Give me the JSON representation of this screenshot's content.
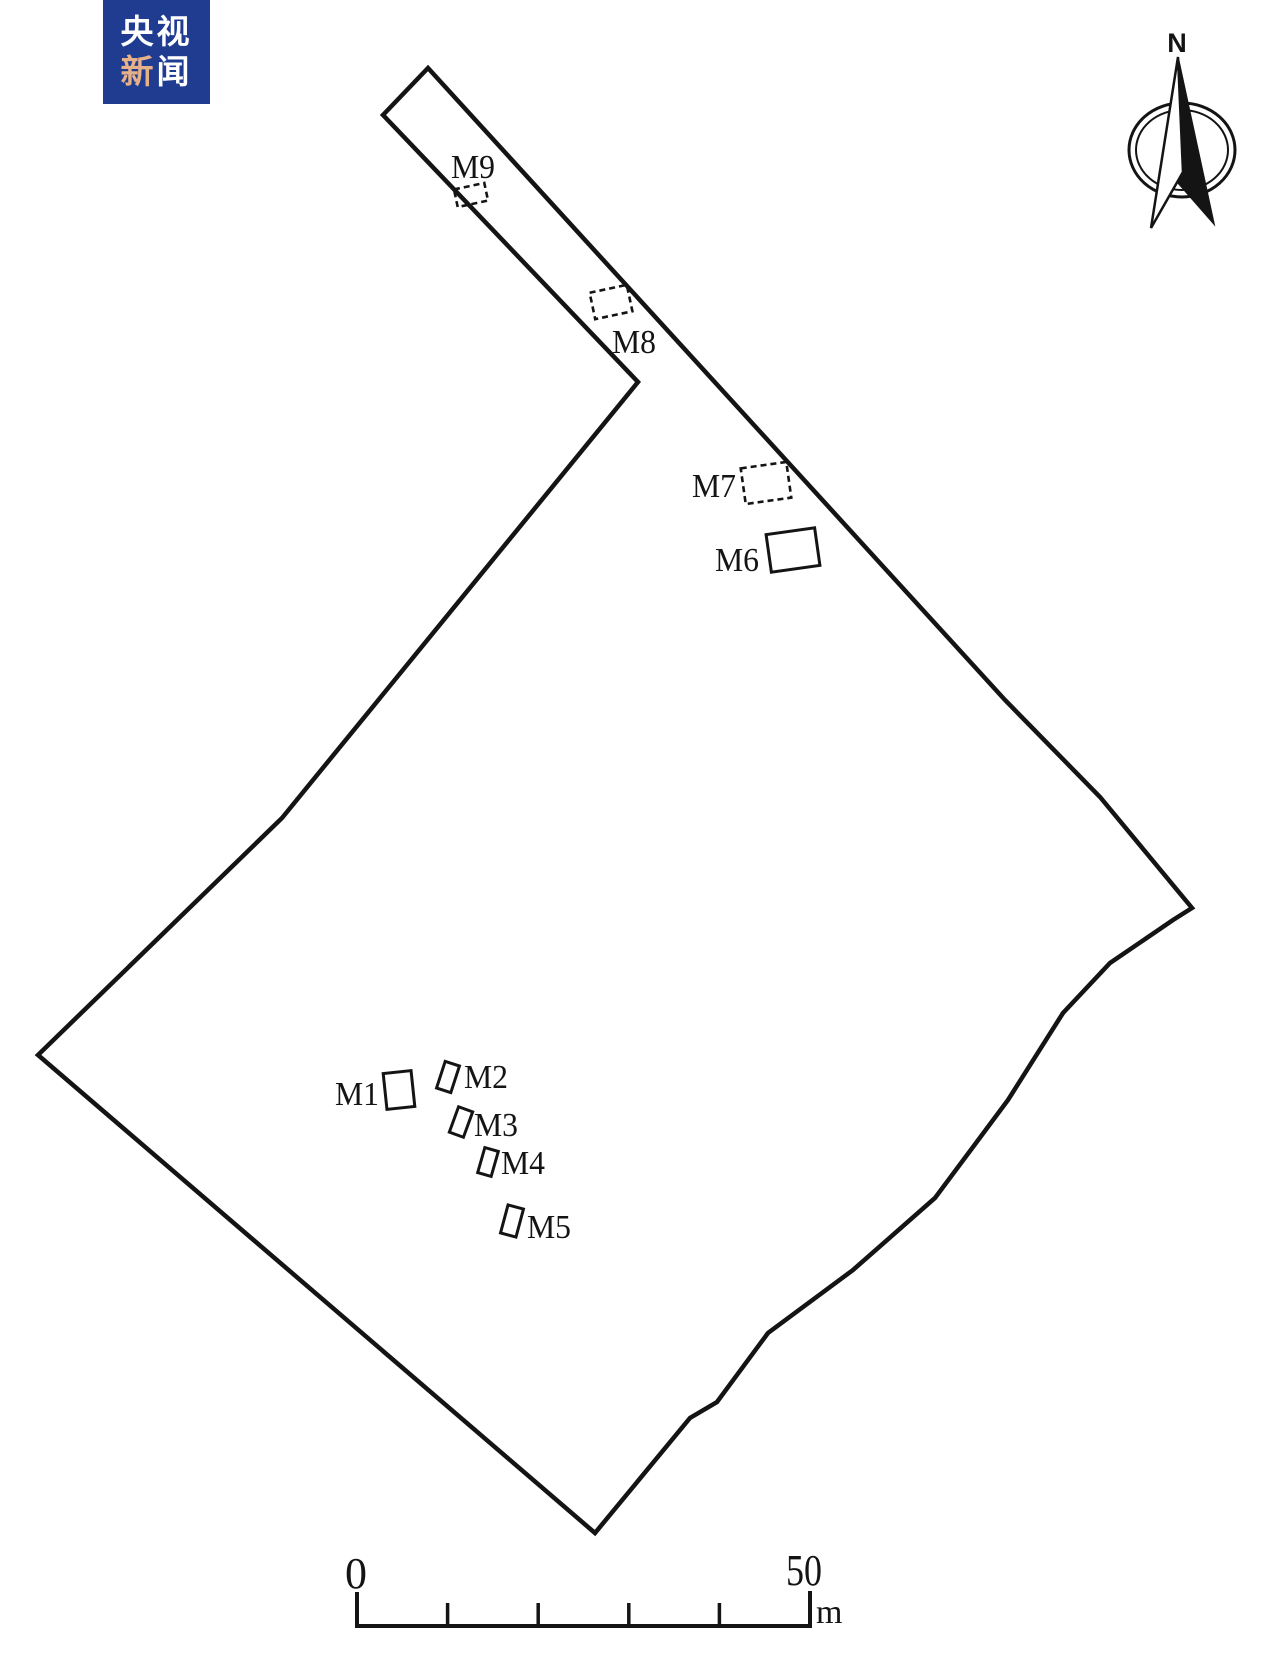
{
  "meta": {
    "background_color": "#ffffff",
    "ink_color": "#141414",
    "figure_type": "archaeological site plan"
  },
  "logo": {
    "line1": "央视",
    "line2_char1": "新",
    "line2_char2": "闻",
    "bg_color": "#1f3c90",
    "text_color": "#ffffff",
    "accent_color": "#e6b088"
  },
  "compass": {
    "label": "N"
  },
  "site_plan": {
    "boundary_points": [
      [
        428,
        68
      ],
      [
        1005,
        700
      ],
      [
        1100,
        797
      ],
      [
        1192,
        908
      ],
      [
        1173,
        920
      ],
      [
        1110,
        963
      ],
      [
        1063,
        1013
      ],
      [
        1008,
        1100
      ],
      [
        935,
        1198
      ],
      [
        853,
        1270
      ],
      [
        768,
        1333
      ],
      [
        717,
        1402
      ],
      [
        690,
        1418
      ],
      [
        595,
        1533
      ],
      [
        38,
        1055
      ],
      [
        282,
        818
      ],
      [
        638,
        382
      ],
      [
        383,
        115
      ]
    ],
    "tombs": [
      {
        "id": "M9",
        "label": "M9",
        "dashed": true,
        "cx": 471,
        "cy": 195,
        "w": 31,
        "h": 18,
        "rot": -12,
        "label_x": 473,
        "label_y": 178,
        "label_len": 44
      },
      {
        "id": "M8",
        "label": "M8",
        "dashed": true,
        "cx": 611,
        "cy": 302,
        "w": 38,
        "h": 27,
        "rot": -12,
        "label_x": 634,
        "label_y": 353,
        "label_len": 44
      },
      {
        "id": "M7",
        "label": "M7",
        "dashed": true,
        "cx": 766,
        "cy": 483,
        "w": 46,
        "h": 36,
        "rot": -8,
        "label_x": 714,
        "label_y": 497,
        "label_len": 44
      },
      {
        "id": "M6",
        "label": "M6",
        "dashed": false,
        "cx": 793,
        "cy": 550,
        "w": 49,
        "h": 38,
        "rot": -8,
        "label_x": 737,
        "label_y": 571,
        "label_len": 44
      },
      {
        "id": "M1",
        "label": "M1",
        "dashed": false,
        "cx": 399,
        "cy": 1090,
        "w": 28,
        "h": 36,
        "rot": -6,
        "label_x": 357,
        "label_y": 1105,
        "label_len": 44
      },
      {
        "id": "M2",
        "label": "M2",
        "dashed": false,
        "cx": 448,
        "cy": 1077,
        "w": 15,
        "h": 28,
        "rot": 18,
        "label_x": 486,
        "label_y": 1088,
        "label_len": 44
      },
      {
        "id": "M3",
        "label": "M3",
        "dashed": false,
        "cx": 461,
        "cy": 1122,
        "w": 15,
        "h": 27,
        "rot": 20,
        "label_x": 496,
        "label_y": 1136,
        "label_len": 44
      },
      {
        "id": "M4",
        "label": "M4",
        "dashed": false,
        "cx": 488,
        "cy": 1162,
        "w": 14,
        "h": 26,
        "rot": 16,
        "label_x": 523,
        "label_y": 1174,
        "label_len": 44
      },
      {
        "id": "M5",
        "label": "M5",
        "dashed": false,
        "cx": 512,
        "cy": 1221,
        "w": 16,
        "h": 29,
        "rot": 15,
        "label_x": 549,
        "label_y": 1238,
        "label_len": 44
      }
    ]
  },
  "scale_bar": {
    "start_label": "0",
    "end_label": "50",
    "unit": "m",
    "divisions": 5,
    "layout": {
      "x0": 357,
      "x1": 810,
      "y": 1626,
      "end_tick_top": 1592,
      "inner_tick_top": 1603
    }
  }
}
